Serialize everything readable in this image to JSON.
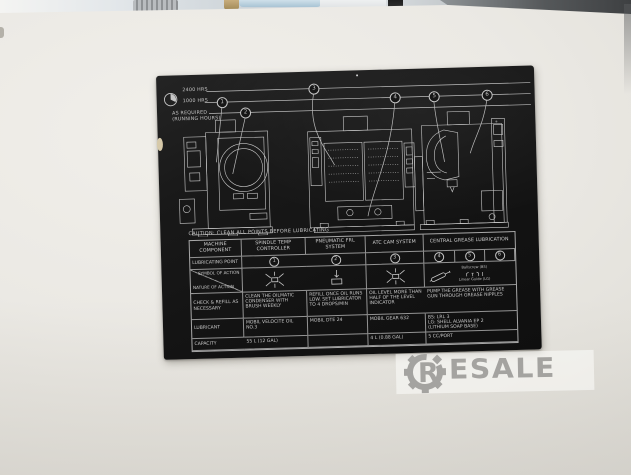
{
  "colors": {
    "label_bg": "#161616",
    "label_text": "#c6c6c6",
    "panel": "#ebe9e4",
    "watermark": "#a4a3a0"
  },
  "photo": {
    "watermark": {
      "gear_letter": "R",
      "rest": "ESALE"
    }
  },
  "label": {
    "legend": {
      "intervals": [
        "2400 HRS",
        "1000 HRS",
        "AS REQUIRED",
        "(RUNNING HOURS)"
      ],
      "points": [
        "1",
        "2",
        "3",
        "4",
        "5",
        "6"
      ]
    },
    "caution": "CAUTION: CLEAN ALL POINTS BEFORE LUBRICATING",
    "table": {
      "headers": [
        "MACHINE COMPONENT",
        "SPINDLE TEMP CONTROLLER",
        "PNEUMATIC FRL SYSTEM",
        "ATC CAM SYSTEM",
        "CENTRAL GREASE LUBRICATION"
      ],
      "row_labels": {
        "point": "LUBRICATING POINT",
        "symbol_top": "SYMBOL OF ACTION",
        "symbol_bottom": "NATURE OF ACTION",
        "check": "CHECK & REFILL AS NECESSARY",
        "lubricant": "LUBRICANT",
        "capacity": "CAPACITY"
      },
      "symbol_notes": [
        "Ballscrew (BS)",
        "Linear Guide (LG)"
      ],
      "check_cells": [
        "CLEAN THE OILMATIC CONDENSER WITH BRUSH WEEKLY",
        "REFILL ONCE OIL RUNS LOW. SET LUBRICATOR TO 4 DROPS/MIN",
        "OIL LEVEL MORE THAN HALF OF THE LEVEL INDICATOR",
        "PUMP THE GREASE WITH GREASE GUN THROUGH GREASE NIPPLES"
      ],
      "lubricant_cells": [
        "MOBIL VELOCITE OIL NO.3",
        "MOBIL DTE 24",
        "MOBIL GEAR 632",
        "BS: LRL 3\nLG: SHELL ALVANIA EP 2\n(LITHIUM SOAP BASE)"
      ],
      "capacity_cells": [
        "55 L (12 GAL)",
        "",
        "4 L (0.88 GAL)",
        "5 CC/PORT"
      ]
    }
  }
}
